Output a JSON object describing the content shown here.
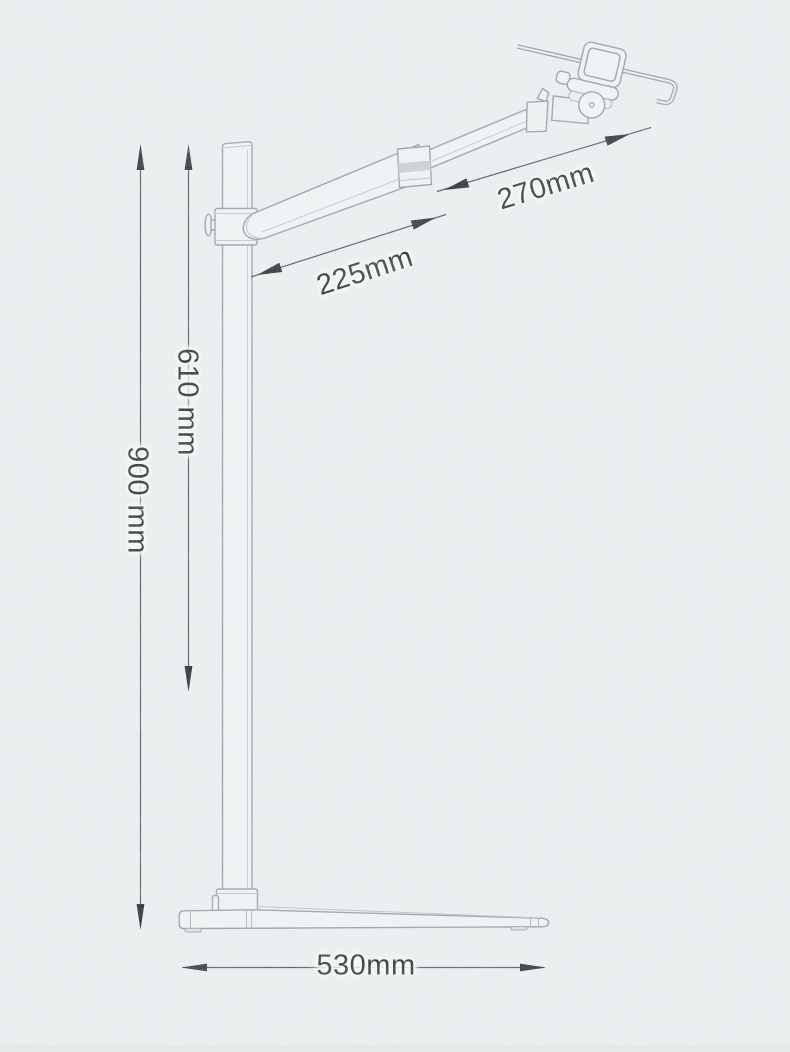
{
  "diagram": {
    "subject": "Line drawing of a floor stand with articulated tablet arm, annotated with five dimensions",
    "unit": "mm",
    "labels": {
      "total_height": "900 mm",
      "pole_height": "610 mm",
      "lower_arm": "225mm",
      "upper_arm": "270mm",
      "base_length": "530mm"
    },
    "colors": {
      "paper_background": "#edf1f2",
      "line_art_stroke": "#8f979d",
      "dimension_line": "#46494c",
      "arrowhead_fill": "#1b1d1f",
      "label_text": "#1d2023",
      "label_halo": "#ffffff"
    }
  }
}
